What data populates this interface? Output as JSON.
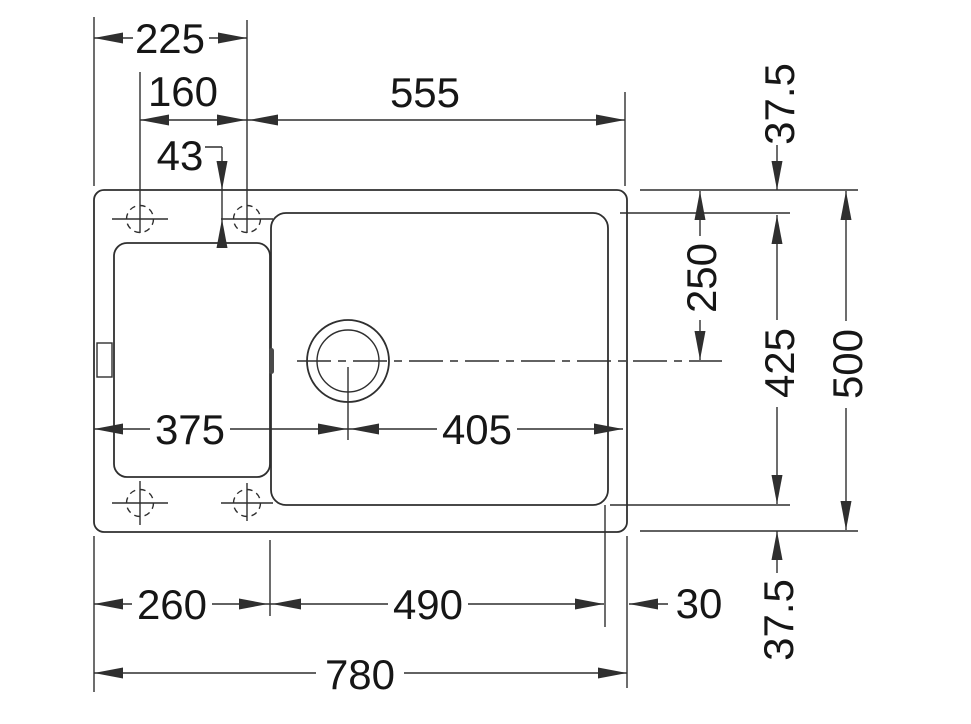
{
  "drawing": {
    "subject": "Kitchen sink with drainer - top view installation dimension drawing",
    "units": "mm",
    "colors": {
      "background": "#ffffff",
      "line": "#2f2f2f",
      "text": "#161616"
    }
  },
  "dimensions": {
    "d225": "225",
    "d160": "160",
    "d43": "43",
    "d555": "555",
    "d37_5_top": "37.5",
    "d250": "250",
    "d425": "425",
    "d500": "500",
    "d37_5_bottom": "37.5",
    "d375": "375",
    "d405": "405",
    "d260": "260",
    "d490": "490",
    "d30": "30",
    "d780": "780"
  }
}
